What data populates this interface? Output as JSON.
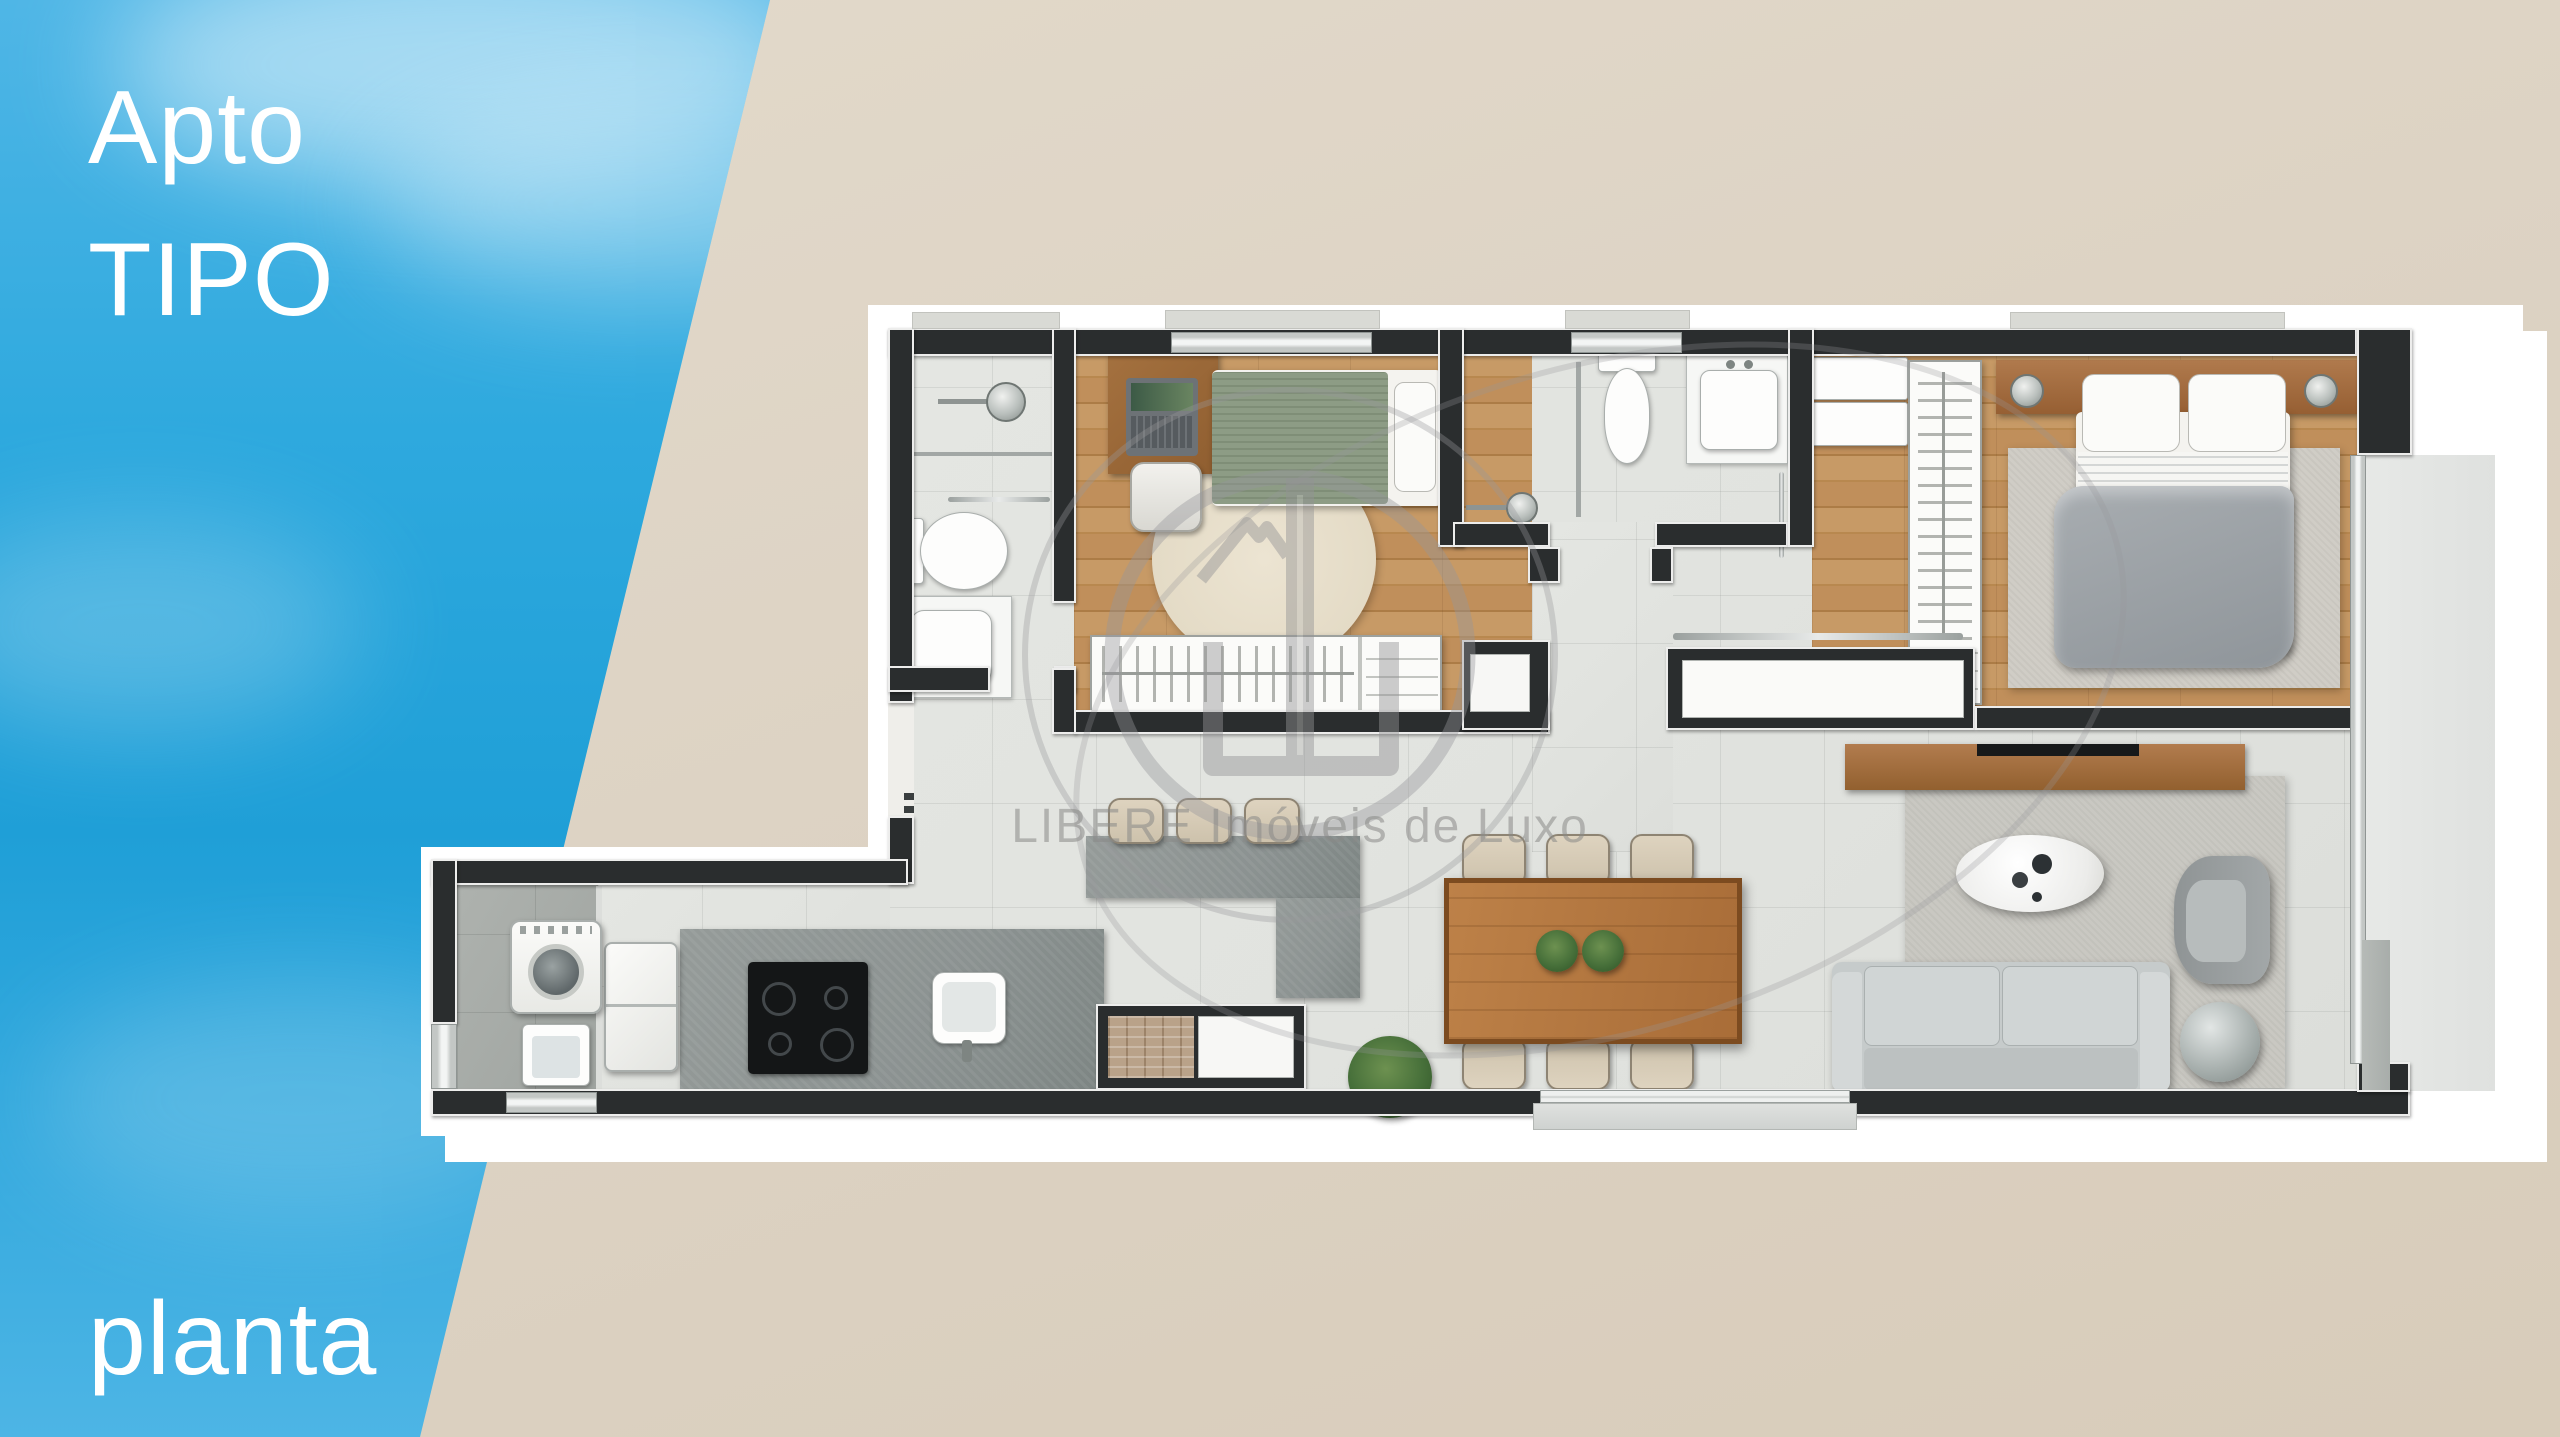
{
  "header": {
    "title_line1": "Apto",
    "title_line2": "TIPO",
    "caption": "planta"
  },
  "watermark": {
    "text": "LIBERE Imóveis de Luxo"
  },
  "colors": {
    "accent_blue": "#2ca8de",
    "bg_beige": "#ddd3c4",
    "wall_dark": "#2a2d2e",
    "wood_floor": "#c2925f",
    "wood_furniture": "#a9744a",
    "marble": "#e1e3df",
    "granite": "#8b9291",
    "watermark_gray": "#939395",
    "text_white": "#ffffff"
  }
}
